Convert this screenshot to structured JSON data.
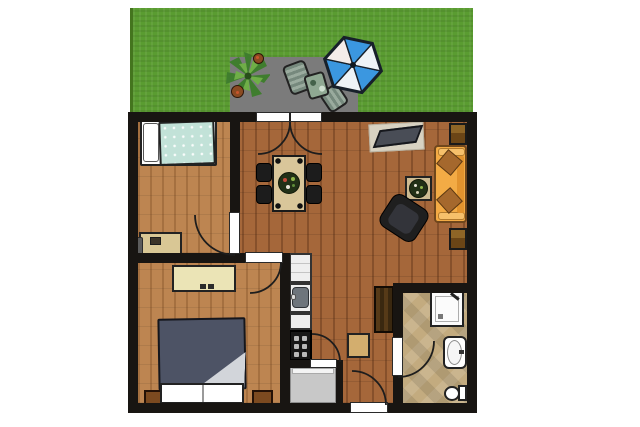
{
  "scene": {
    "type": "apartment floor plan with garden terrace, top-down view",
    "background_color": "#ffffff",
    "wall_color": "#181512"
  },
  "garden": {
    "name": "lawn with terrace",
    "grass_color": "#5a9c31",
    "patio_color": "#7b7b7b",
    "items": [
      {
        "name": "potted-plant",
        "colors": [
          "#3f7d2e",
          "#6aa944"
        ]
      },
      {
        "name": "flower-pot-small",
        "color": "#8a4a22"
      },
      {
        "name": "flower-pot-large",
        "color": "#8a4a22"
      },
      {
        "name": "garden-chair-1",
        "color": "#86998c"
      },
      {
        "name": "garden-chair-2",
        "color": "#86998c"
      },
      {
        "name": "garden-table",
        "color": "#8fa892"
      },
      {
        "name": "parasol",
        "shape": "hexagon",
        "panel_colors": [
          "#3b97e0",
          "#eef3f6"
        ],
        "panels": 6
      }
    ]
  },
  "rooms": [
    {
      "name": "bedroom-1",
      "position": "top-left",
      "floor": "light wood",
      "furniture": [
        "single bed with white pillow and pale-teal blanket",
        "desk with chair"
      ]
    },
    {
      "name": "bedroom-2",
      "position": "bottom-left",
      "floor": "light wood",
      "furniture": [
        "double bed with dark slate duvet and two white pillows",
        "cream dresser",
        "nightstand left",
        "nightstand right"
      ]
    },
    {
      "name": "living-room",
      "position": "right",
      "floor": "dark wood",
      "furniture": [
        "dining table with plant centerpiece",
        "4 black dining chairs",
        "tv on mat",
        "orange sofa with 2 brown cushions",
        "coffee table with plant",
        "black armchair",
        "2 brown wall units"
      ]
    },
    {
      "name": "kitchen",
      "position": "bottom-center-left",
      "floor": "dark wood",
      "furniture": [
        "fridge unit",
        "sink unit",
        "counter",
        "stove with 4 burners"
      ]
    },
    {
      "name": "storage-room",
      "position": "bottom-center",
      "floor": "gray"
    },
    {
      "name": "hallway",
      "position": "bottom-center-right",
      "floor": "dark wood",
      "furniture": [
        "small side table",
        "dark wardrobe"
      ]
    },
    {
      "name": "bathroom",
      "position": "bottom-right",
      "floor": "beige diagonal tiles",
      "furniture": [
        "shower cabin",
        "wash basin",
        "toilet"
      ]
    }
  ],
  "doors": [
    {
      "name": "terrace-double-door",
      "between": [
        "living-room",
        "patio"
      ]
    },
    {
      "name": "bedroom1-door",
      "between": [
        "bedroom-1",
        "living-room"
      ]
    },
    {
      "name": "bedroom2-door",
      "between": [
        "bedroom-2",
        "living-room"
      ]
    },
    {
      "name": "storage-door",
      "between": [
        "storage-room",
        "kitchen"
      ]
    },
    {
      "name": "bathroom-door",
      "between": [
        "hallway",
        "bathroom"
      ]
    },
    {
      "name": "entrance-door",
      "between": [
        "hallway",
        "outside"
      ]
    }
  ],
  "palette": {
    "wood_dark": "#a5673a",
    "wood_light": "#bd8551",
    "tile": "#c3ab7f",
    "sofa_orange": "#f3ab45",
    "bed2_duvet": "#4d5365",
    "bed1_blanket": "#c2e2d8",
    "parasol_blue": "#3b97e0",
    "grass": "#5a9c31"
  }
}
